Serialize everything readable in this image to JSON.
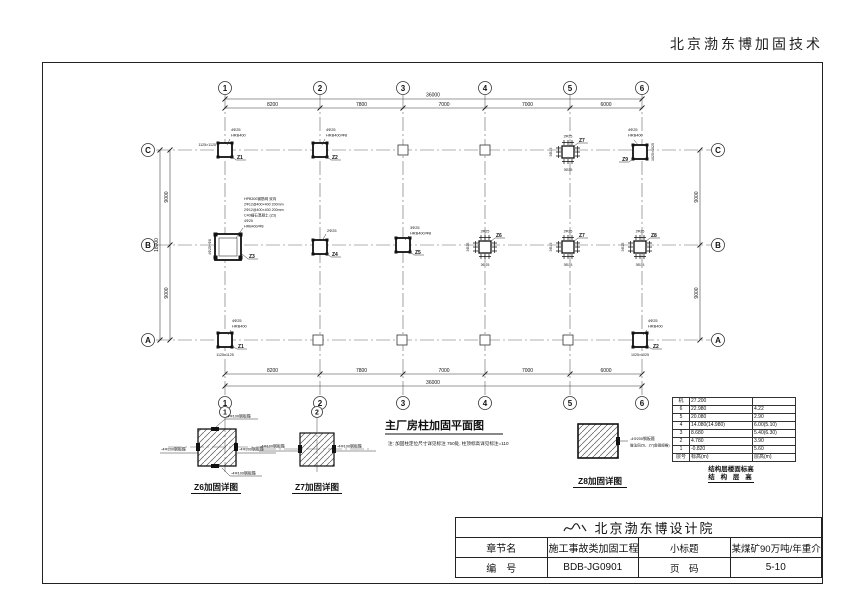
{
  "header": {
    "brand": "北京渤东博加固技术"
  },
  "plan": {
    "title": "主厂房柱加固平面图",
    "note": "注: 加固柱定位尺寸详见标注 750处, 柱顶标高详见标注=110",
    "axes_top": [
      "1",
      "2",
      "3",
      "4",
      "5",
      "6"
    ],
    "axes_left": [
      "C",
      "B",
      "A"
    ],
    "dims_h": [
      "8200",
      "7800",
      "7000",
      "7000",
      "6000"
    ],
    "dim_h_total": "36000",
    "dims_v": [
      "9000",
      "9000"
    ],
    "dim_v_total": "18000",
    "cluster": {
      "top": "2Φ25",
      "bottom": "3Φ25",
      "side": "3Φ25"
    },
    "columns": {
      "c1": {
        "label": "Z1",
        "ann1": "4Φ25",
        "ann2": "HRB400",
        "size": "1125×1125"
      },
      "c2": {
        "label": "Z2",
        "ann1": "4Φ25",
        "ann2": "HRB400/Φ8"
      },
      "c5": {
        "label": "Z7"
      },
      "c6": {
        "label": "Z9",
        "ann1": "4Φ25",
        "ann2": "HRB400",
        "size": "1025×1025"
      },
      "b1": {
        "label": "Z3",
        "ann": [
          "HPB300钢筋网 双向",
          "2Φ12@400×400 200mm",
          "2Φ12@400×400 200mm",
          "C40细石混凝土 (Z3)",
          "4Φ25",
          "HRB400/Φ8"
        ],
        "side": "4Φ25+Φ8"
      },
      "b2": {
        "label": "Z4",
        "ann1": "2Φ25"
      },
      "b3": {
        "label": "Z5",
        "ann1": "3Φ25",
        "ann2": "HRB400/Φ8"
      },
      "b4": {
        "label": "Z6"
      },
      "b5": {
        "label": "Z7"
      },
      "b6": {
        "label": "Z8"
      },
      "a1": {
        "label": "Z1",
        "ann1": "4Φ25",
        "ann2": "HRB400",
        "size": "1125×1125"
      },
      "a6": {
        "label": "Z2",
        "ann1": "4Φ25",
        "ann2": "HRB400",
        "size": "1025×1025"
      }
    }
  },
  "details": {
    "z6": {
      "title": "Z6加固详图",
      "axis": "1",
      "top": "-4Φ100钢板箍",
      "left": "-4Φ200钢板箍",
      "right": "-4Φ200钢板箍",
      "bottom": "-4Φ100钢板箍"
    },
    "z7": {
      "title": "Z7加固详图",
      "axis": "2",
      "left": "-4Φ100钢板箍",
      "right": "-4Φ100钢板箍"
    },
    "z8": {
      "title": "Z8加固详图",
      "line1": "-4Φ200钢板箍",
      "line2": "做法同Z6、Z7(角钢规格)"
    }
  },
  "floor_table": {
    "rows": [
      [
        "机",
        "27.200",
        ""
      ],
      [
        "6",
        "22.980",
        "4.22"
      ],
      [
        "5",
        "20.080",
        "2.90"
      ],
      [
        "4",
        "14.080(14.980)",
        "6.00(5.10)"
      ],
      [
        "3",
        "8.680",
        "5.40(6.30)"
      ],
      [
        "2",
        "4.780",
        "3.90"
      ],
      [
        "1",
        "-0.820",
        "5.60"
      ],
      [
        "层号",
        "标高(m)",
        "层高(m)"
      ]
    ],
    "caption1": "结构层楼面标高",
    "caption2": "结 构 层 高"
  },
  "titleblock": {
    "institute": "北京渤东博设计院",
    "row1_label": "章节名",
    "row1_value": "施工事故类加固工程",
    "row1_label2": "小标题",
    "row1_value2": "某煤矿90万吨/年重介选煤厂加固说明",
    "row2_label": "编　号",
    "row2_value": "BDB-JG0901",
    "row2_label2": "页　码",
    "row2_value2": "5-10"
  }
}
